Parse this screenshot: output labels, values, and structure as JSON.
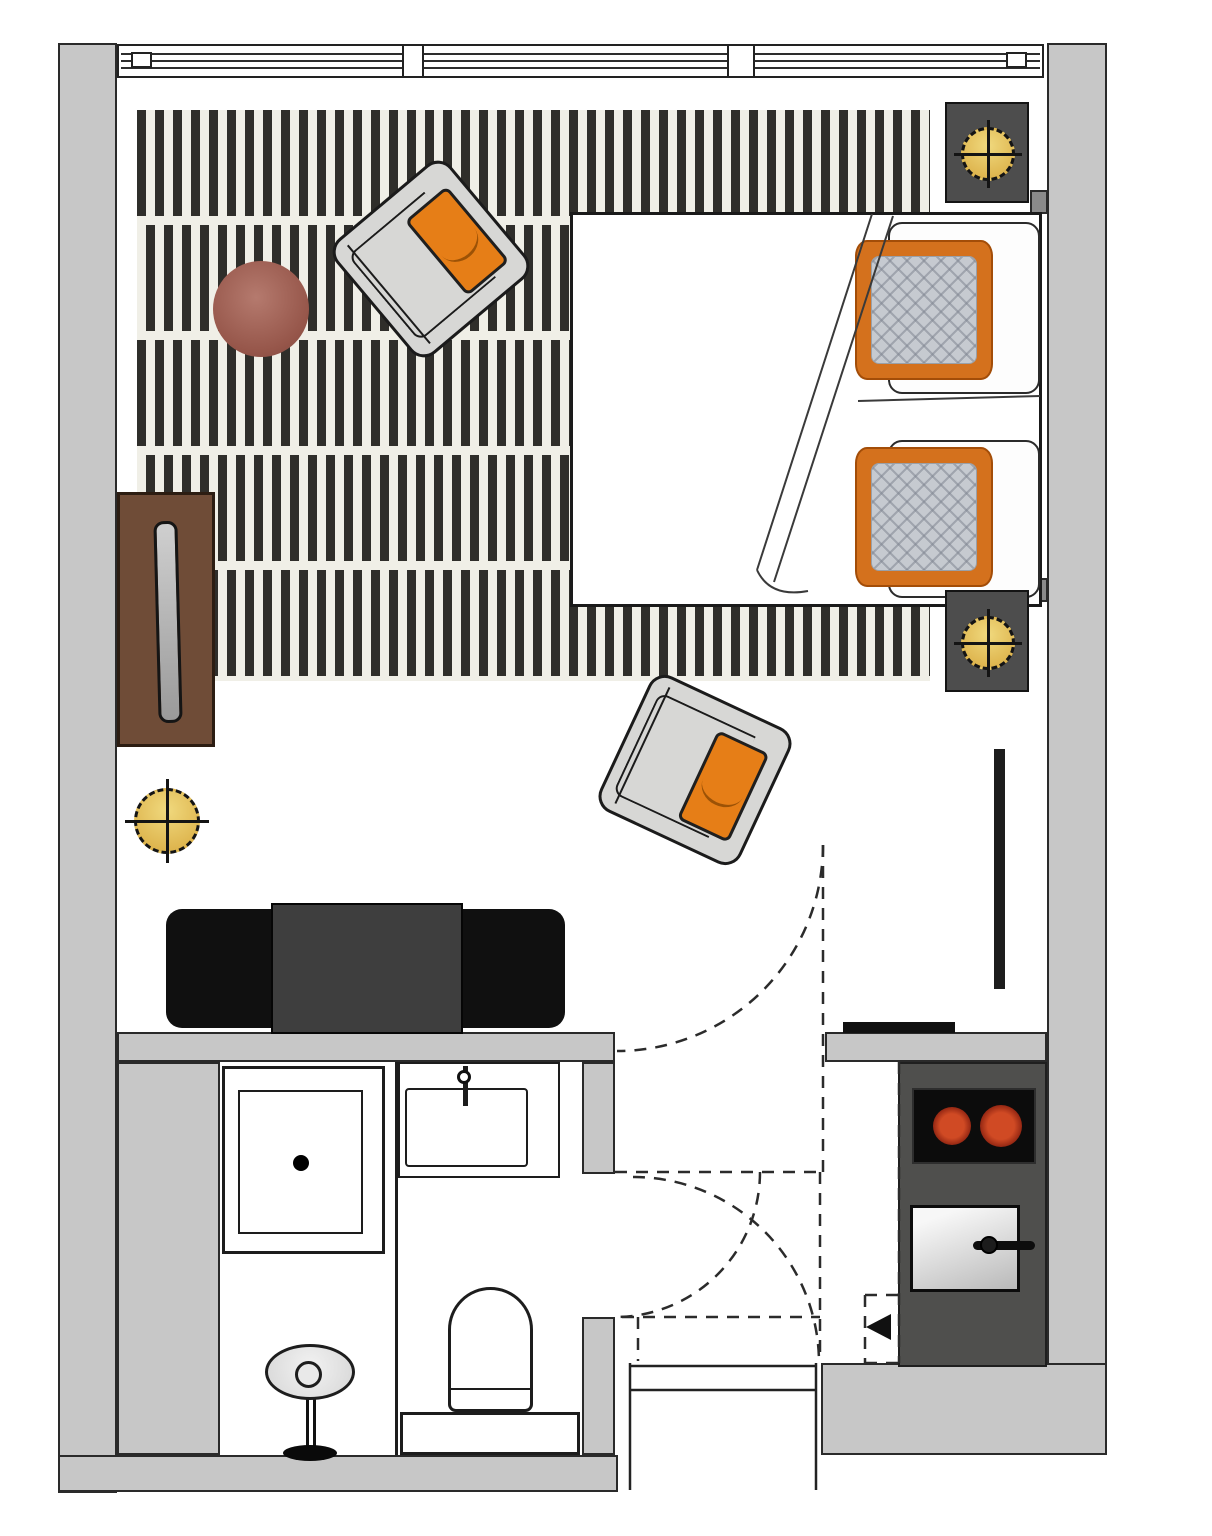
{
  "page": {
    "kind": "floor_plan",
    "description": "Top-down architectural floor plan of a studio apartment with combined living/sleeping area, bathroom at lower left, kitchenette at lower right and an entry vestibule with dashed door swings",
    "visible_text": []
  },
  "palette": {
    "wall_fill": "#c7c7c7",
    "wall_outline": "#2a2a2a",
    "rug_base": "#f0efe7",
    "rug_stripe": "#2f2e2a",
    "accent_orange": "#e67e17",
    "pillow_orange": "#d4711d",
    "pillow_quilt_gray": "#c6cad0",
    "wood_brown": "#6f4c37",
    "table_maroon": "#96564a",
    "lamp_yellow": "#d9ab41",
    "nightstand_gray": "#4d4d4d",
    "console_black": "#101010",
    "tv_gray": "#3e3e3e",
    "counter_dark": "#4f4f4d",
    "cooktop_black": "#0c0c0c",
    "burner_red": "#d04a24"
  },
  "windows": {
    "sections": 3,
    "location": "top wall"
  },
  "lighting": {
    "ceiling_lamp_symbols": 3
  },
  "door_swings_dashed": 3,
  "areas": {
    "living_sleeping": {
      "items": [
        "striped-rug",
        "armchair-1",
        "armchair-2",
        "round-side-table",
        "wall-cabinet-with-mirror",
        "double-bed",
        "orange-pillow-1",
        "orange-pillow-2",
        "white-pillow-1",
        "white-pillow-2",
        "nightstand-1",
        "nightstand-2",
        "ceiling-lamp-1",
        "ceiling-lamp-2",
        "ceiling-lamp-3",
        "tv-console",
        "tv",
        "wardrobe-panel"
      ]
    },
    "bathroom": {
      "items": [
        "vanity-strip",
        "shower",
        "washbasin",
        "faucet",
        "toilet",
        "stool"
      ]
    },
    "kitchen": {
      "items": [
        "kitchen-counter",
        "cooktop",
        "burner-left",
        "burner-right",
        "oven",
        "oven-handle",
        "entry-arrow"
      ]
    },
    "entry": {
      "items": [
        "entry-threshold",
        "vestibule-dashed-outline",
        "entry-door-swing",
        "bathroom-door-swing"
      ]
    }
  }
}
